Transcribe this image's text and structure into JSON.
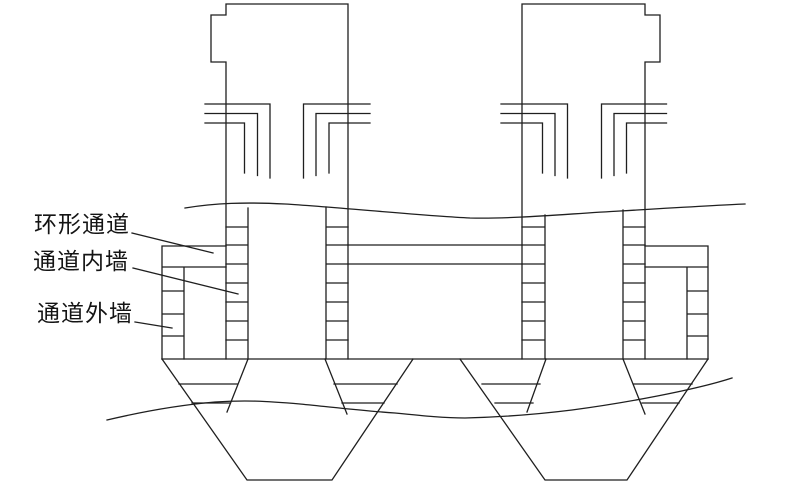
{
  "figure": {
    "kind": "pylon-caisson-section-diagram",
    "labels": {
      "annular_channel": "环形通道",
      "channel_inner_wall": "通道内墙",
      "channel_outer_wall": "通道外墙"
    }
  },
  "colors": {
    "line": "#1f1f1f",
    "background": "#ffffff"
  }
}
